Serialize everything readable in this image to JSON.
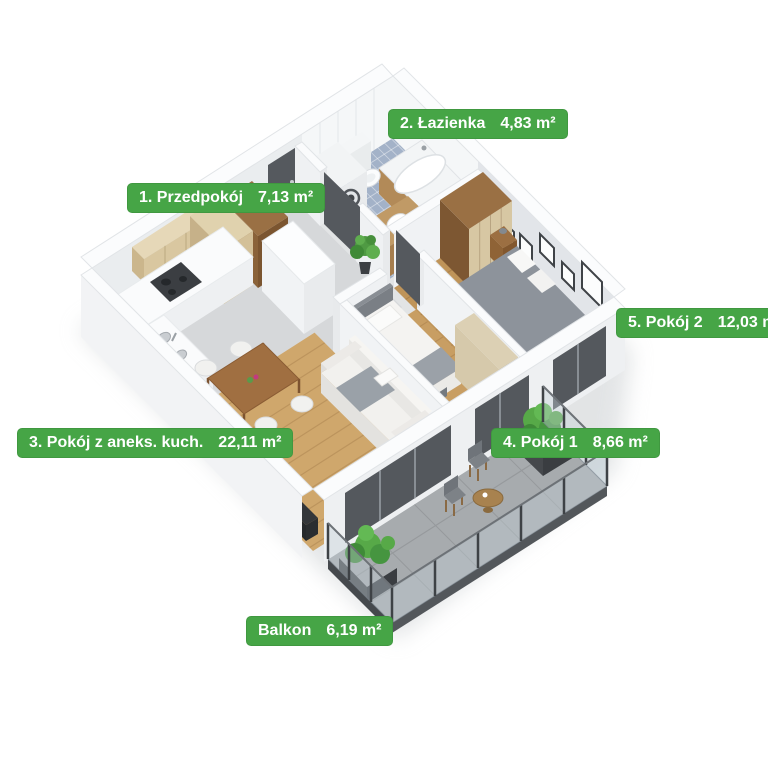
{
  "labels": [
    {
      "name": "1. Przedpokój",
      "area": "7,13 m²"
    },
    {
      "name": "2. Łazienka",
      "area": "4,83 m²"
    },
    {
      "name": "3. Pokój z aneks. kuch.",
      "area": "22,11 m²"
    },
    {
      "name": "4. Pokój 1",
      "area": "8,66 m²"
    },
    {
      "name": "5. Pokój 2",
      "area": "12,03 m²"
    },
    {
      "name": "Balkon",
      "area": "6,19 m²"
    }
  ],
  "colors": {
    "badge_green": "#46a546",
    "badge_text": "#ffffff",
    "wood_living": "#cfa76c",
    "wood_room1": "#c89e63",
    "wood_room2": "#bf9459",
    "concrete": "#d6d8da",
    "bathroom_tile": "#a3b2c8",
    "balcony_floor": "#a7abae",
    "wall_white": "#f2f3f5",
    "plant_green": "#57a948"
  }
}
